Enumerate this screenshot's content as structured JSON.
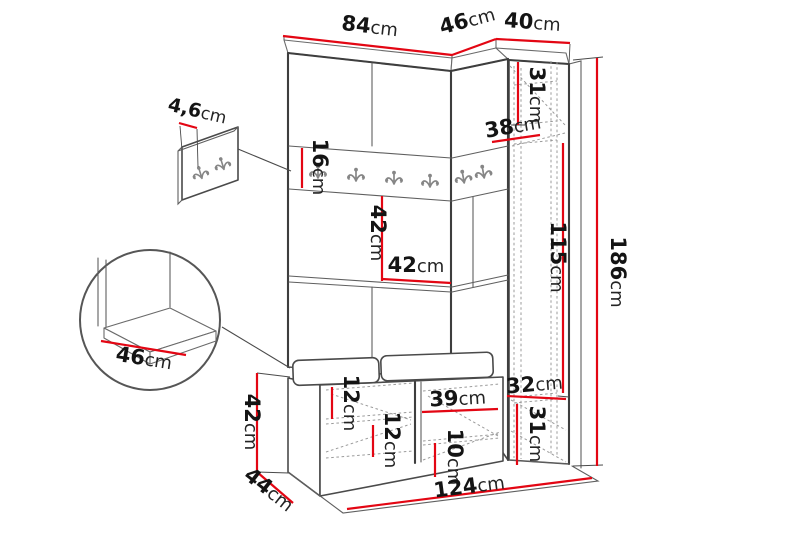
{
  "diagram": {
    "title": "hallway-furniture-dimension-diagram",
    "unit": "cm",
    "colors": {
      "dimension_line": "#e30613",
      "outline": "#3e3e3e",
      "hidden_line": "#9b9b9b",
      "background": "#ffffff"
    },
    "dimensions": {
      "top_width_main": {
        "num": "84",
        "unit": "cm"
      },
      "top_width_corner": {
        "num": "46",
        "unit": "cm"
      },
      "top_width_column": {
        "num": "40",
        "unit": "cm"
      },
      "wall_panel_depth": {
        "num": "4,6",
        "unit": "cm"
      },
      "rail_height": {
        "num": "16",
        "unit": "cm"
      },
      "column_top_height": {
        "num": "31",
        "unit": "cm"
      },
      "column_top_depth": {
        "num": "38",
        "unit": "cm"
      },
      "niche_height": {
        "num": "42",
        "unit": "cm"
      },
      "niche_width": {
        "num": "42",
        "unit": "cm"
      },
      "column_mid_height": {
        "num": "115",
        "unit": "cm"
      },
      "total_height": {
        "num": "186",
        "unit": "cm"
      },
      "column_bottom_depth": {
        "num": "32",
        "unit": "cm"
      },
      "column_bottom_height": {
        "num": "31",
        "unit": "cm"
      },
      "bench_niche_width": {
        "num": "39",
        "unit": "cm"
      },
      "bench_niche_height": {
        "num": "10",
        "unit": "cm"
      },
      "bench_shelf_upper": {
        "num": "12",
        "unit": "cm"
      },
      "bench_shelf_lower": {
        "num": "12",
        "unit": "cm"
      },
      "bench_height": {
        "num": "42",
        "unit": "cm"
      },
      "bench_depth": {
        "num": "44",
        "unit": "cm"
      },
      "total_width": {
        "num": "124",
        "unit": "cm"
      },
      "seat_depth": {
        "num": "46",
        "unit": "cm"
      }
    }
  }
}
